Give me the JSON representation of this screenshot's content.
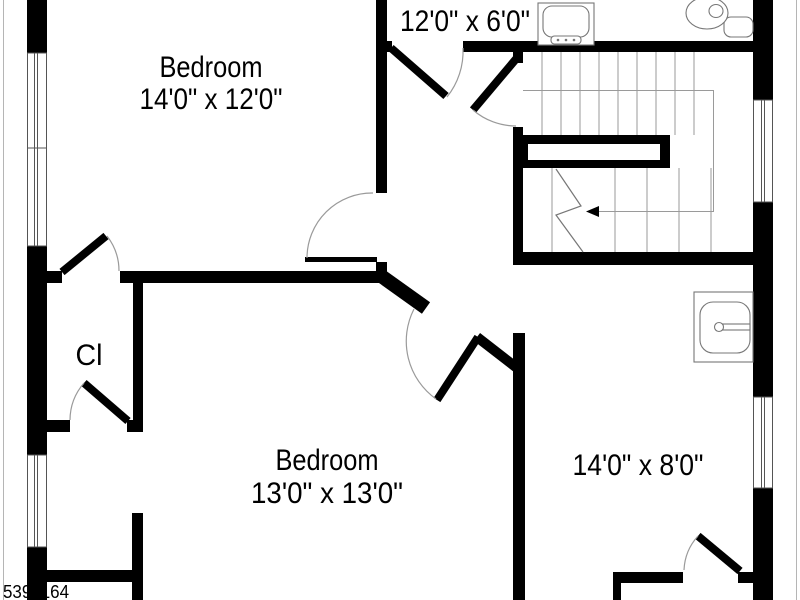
{
  "labels": {
    "bedroom1_name": "Bedroom",
    "bedroom1_dims": "14'0\" x 12'0\"",
    "top_room_dims": "12'0\" x 6'0\"",
    "closet": "Cl",
    "bedroom2_name": "Bedroom",
    "bedroom2_dims": "13'0\" x 13'0\"",
    "right_room_dims": "14'0\" x 8'0\"",
    "watermark": "5398164"
  },
  "colors": {
    "wall": "#000000",
    "thin_line": "#9a9a9a",
    "window_line": "#555555",
    "fixture_line": "#777777",
    "boundary_line": "#b5b5b5",
    "text": "#000000",
    "watermark": "#3a3a3a",
    "background": "#ffffff"
  }
}
